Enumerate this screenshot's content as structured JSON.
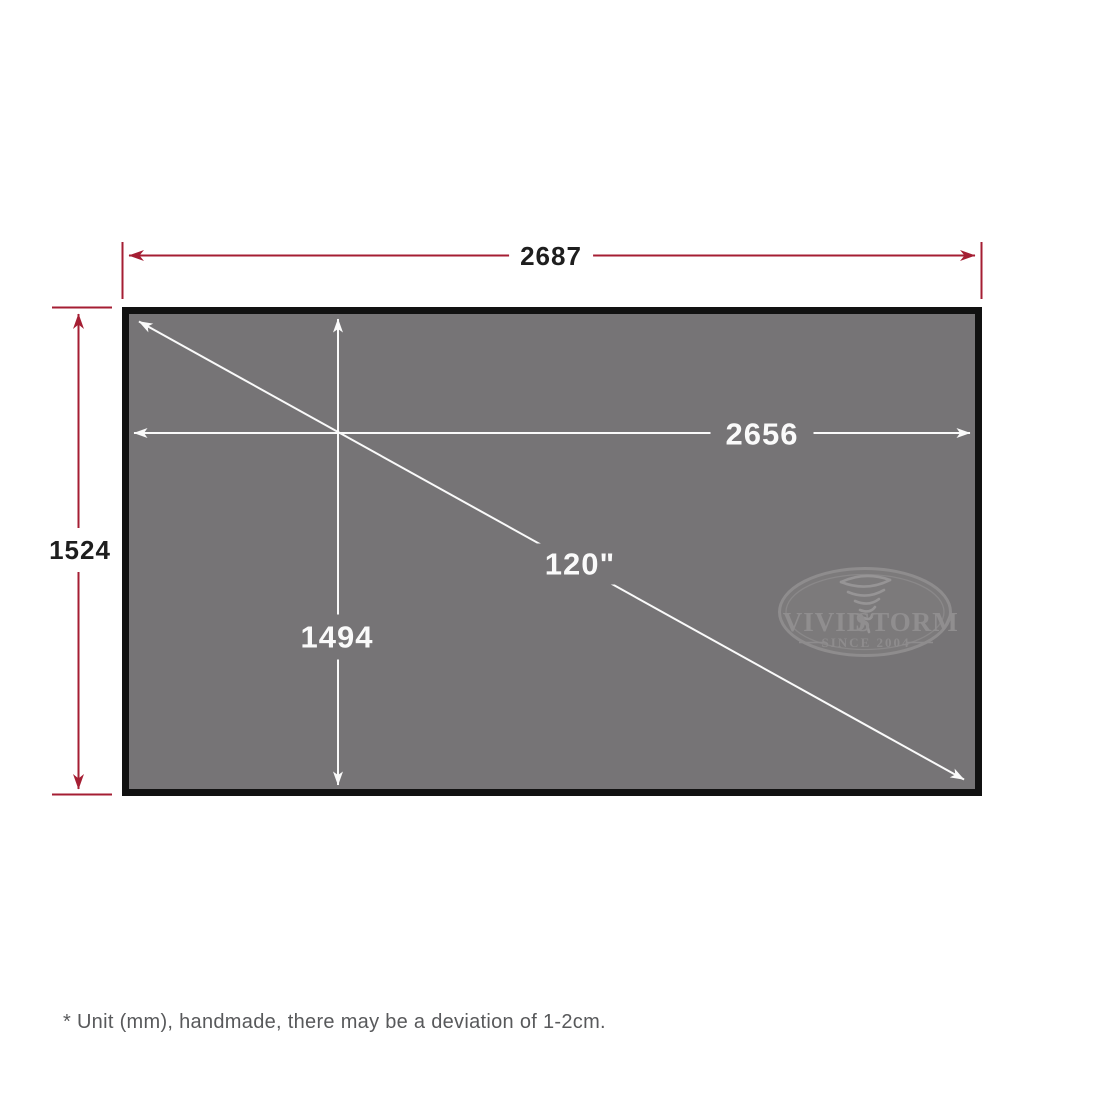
{
  "colors": {
    "background": "#FFFFFF",
    "dimension_red": "#A51E33",
    "screen_fill": "#767476",
    "screen_border": "#111111",
    "inner_dimension_white": "#FAFAFA",
    "logo_gray": "#8E8C8D",
    "footnote_gray": "#58595B"
  },
  "dimensions": {
    "outer_width": "2687",
    "outer_height": "1524",
    "inner_width": "2656",
    "inner_height": "1494",
    "diagonal_size": "120\""
  },
  "logo": {
    "name_left": "VIVID",
    "name_right": "STORM",
    "since": "SINCE 2004",
    "icon": "tornado-icon"
  },
  "footnote": "* Unit (mm), handmade, there may be a deviation of 1-2cm."
}
